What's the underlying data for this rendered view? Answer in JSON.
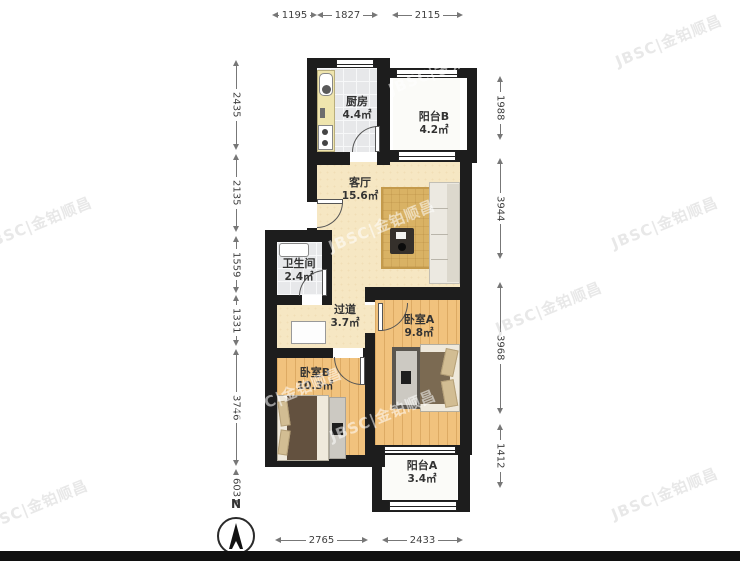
{
  "watermark": {
    "text": "JBSC|金铂顺昌"
  },
  "compass": {
    "label": "N"
  },
  "rooms": {
    "kitchen": {
      "name": "厨房",
      "area": "4.4㎡"
    },
    "balcony_b": {
      "name": "阳台B",
      "area": "4.2㎡"
    },
    "living": {
      "name": "客厅",
      "area": "15.6㎡"
    },
    "bathroom": {
      "name": "卫生间",
      "area": "2.4㎡"
    },
    "hallway": {
      "name": "过道",
      "area": "3.7㎡"
    },
    "bedroom_a": {
      "name": "卧室A",
      "area": "9.8㎡"
    },
    "bedroom_b": {
      "name": "卧室B",
      "area": "10.3㎡"
    },
    "balcony_a": {
      "name": "阳台A",
      "area": "3.4㎡"
    }
  },
  "dimensions_mm": {
    "top": [
      "1195",
      "1827",
      "2115"
    ],
    "bottom": [
      "2765",
      "2433"
    ],
    "left": [
      "2435",
      "2135",
      "1559",
      "1331",
      "3746",
      "603"
    ],
    "right": [
      "1988",
      "3944",
      "3968",
      "1412"
    ]
  },
  "colors": {
    "wall": "#1d1d1d",
    "wood_floor": "#f1c27d",
    "tile_floor": "#e7e8ea",
    "living_floor": "#f6e7c3",
    "rug": "#d9b264",
    "background": "#ffffff"
  }
}
